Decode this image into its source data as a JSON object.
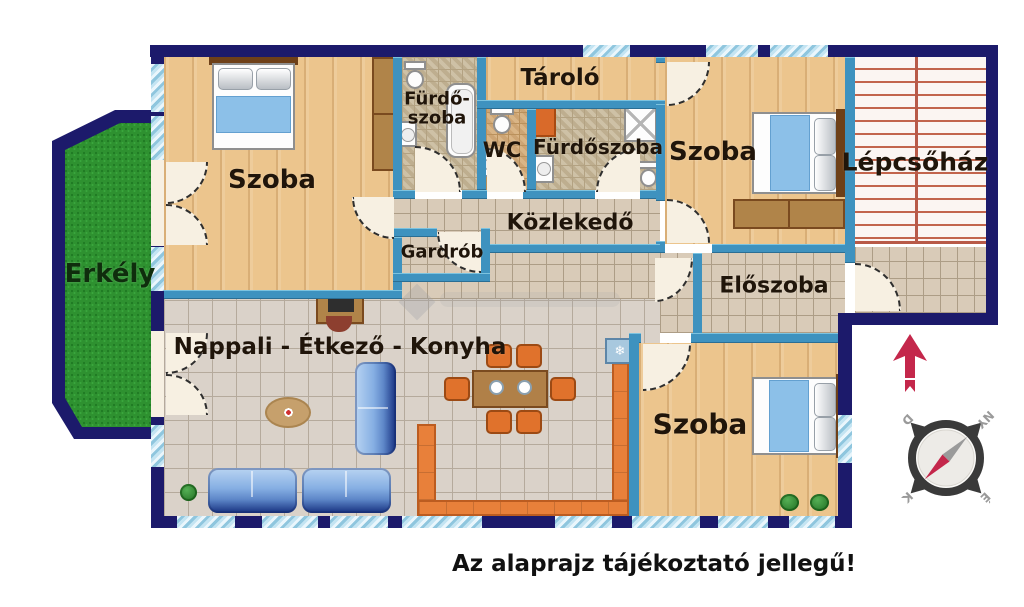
{
  "disclaimer": "Az alaprajz tájékoztató jellegű!",
  "rooms": {
    "szoba_topleft": "Szoba",
    "szoba_topright": "Szoba",
    "szoba_bottom": "Szoba",
    "furdoszoba_small_line1": "Fürdő-",
    "furdoszoba_small_line2": "szoba",
    "wc": "WC",
    "furdoszoba": "Fürdőszoba",
    "tarolo": "Tároló",
    "lepcsohaz": "Lépcsőház",
    "kozlekedo": "Közlekedő",
    "gardrob": "Gardrób",
    "eloszoba": "Előszoba",
    "erkely": "Erkély",
    "nappali": "Nappali - Étkező - Konyha"
  },
  "compass": {
    "north": "É",
    "south": "D",
    "east": "K",
    "west": "NY"
  },
  "icons": {
    "ac": "❄"
  },
  "colors": {
    "wall_outer": "#1c1a6b",
    "wall_inner": "#3e92bf",
    "accent_orange": "#e8803a",
    "blanket_blue": "#8cc0e8",
    "grass_green": "#2e9130",
    "stair_line_red": "#c2644c",
    "compass_red": "#c4274b"
  }
}
